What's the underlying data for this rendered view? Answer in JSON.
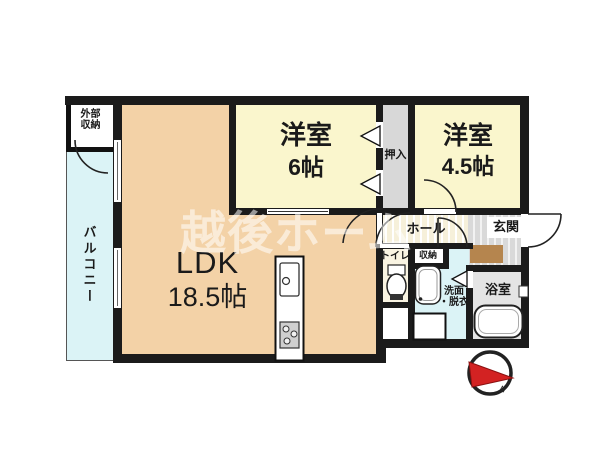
{
  "watermark": {
    "text": "越後ホーム"
  },
  "rooms": {
    "exterior_storage": {
      "label": "外部\n収納"
    },
    "balcony": {
      "label": "バルコニー"
    },
    "ldk": {
      "name": "LDK",
      "size": "18.5帖"
    },
    "western_room_6": {
      "name": "洋室",
      "size": "6帖"
    },
    "oshiire_closet": {
      "label": "押入"
    },
    "western_room_45": {
      "name": "洋室",
      "size": "4.5帖"
    },
    "hall": {
      "label": "ホール"
    },
    "entrance": {
      "label": "玄関"
    },
    "toilet": {
      "label": "トイレ"
    },
    "storage": {
      "label": "収納"
    },
    "washroom": {
      "label": "洗面\n・脱衣"
    },
    "bathroom": {
      "label": "浴室"
    }
  },
  "compass": {
    "letter": "N"
  },
  "colors": {
    "wall": "#1b1b1b",
    "ldk_floor": "#f3d2a7",
    "bedroom_floor": "#faf6cd",
    "balcony_floor": "#dbf3f6",
    "washroom_floor": "#dbf3f6",
    "closet_floor": "#d8d8d8",
    "hall_floor": "#f6f0da",
    "entrance_floor": "#d9d9d9",
    "bath_floor": "#e4e4e4",
    "entrance_step": "#b5854e",
    "compass_needle": "#d32222",
    "watermark": "rgba(255,255,255,0.55)"
  }
}
